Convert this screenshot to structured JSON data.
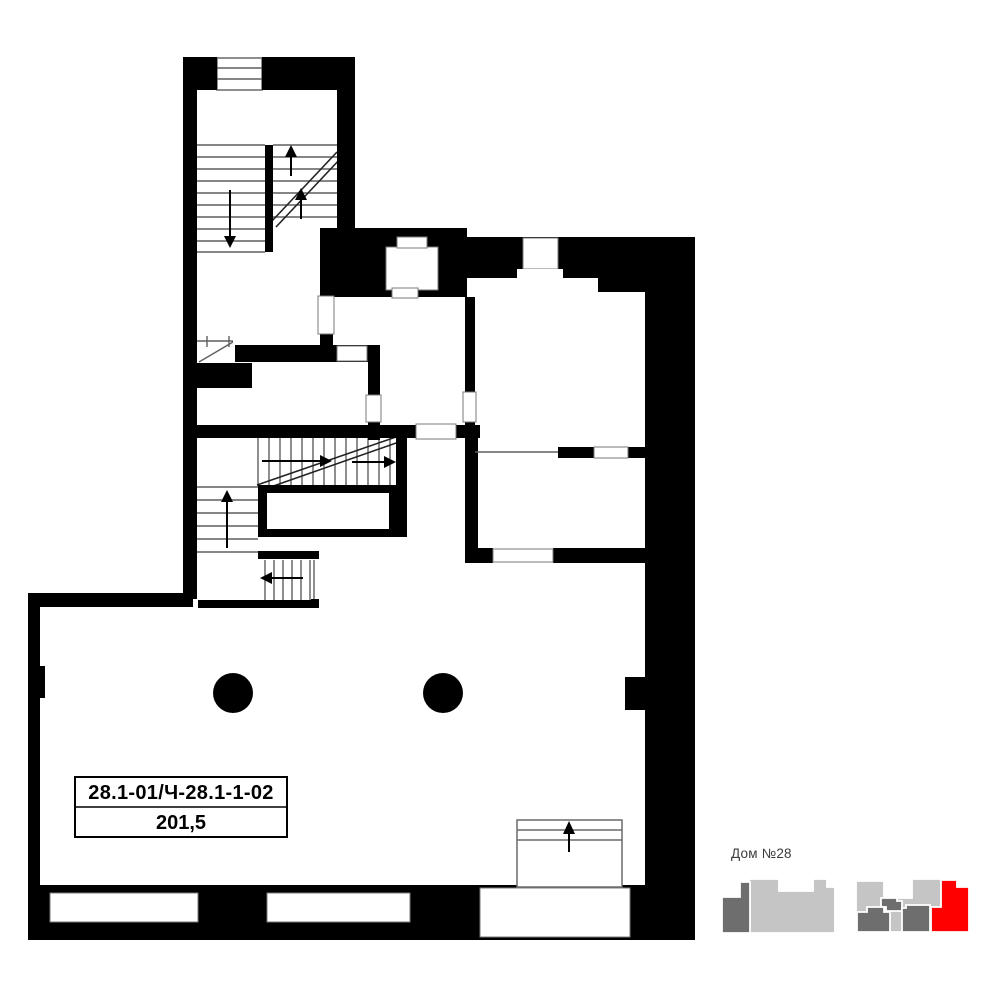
{
  "plan": {
    "unit_label": "28.1-01/Ч-28.1-1-02",
    "unit_area": "201,5"
  },
  "minimap": {
    "house_label": "Дом №28",
    "highlight_color": "#ff0000",
    "building_fill": "#c5c5c5",
    "section_fill": "#6e6e6e"
  },
  "colors": {
    "walls": "#000000",
    "step_lines": "#5f5f5f",
    "background": "#ffffff"
  }
}
